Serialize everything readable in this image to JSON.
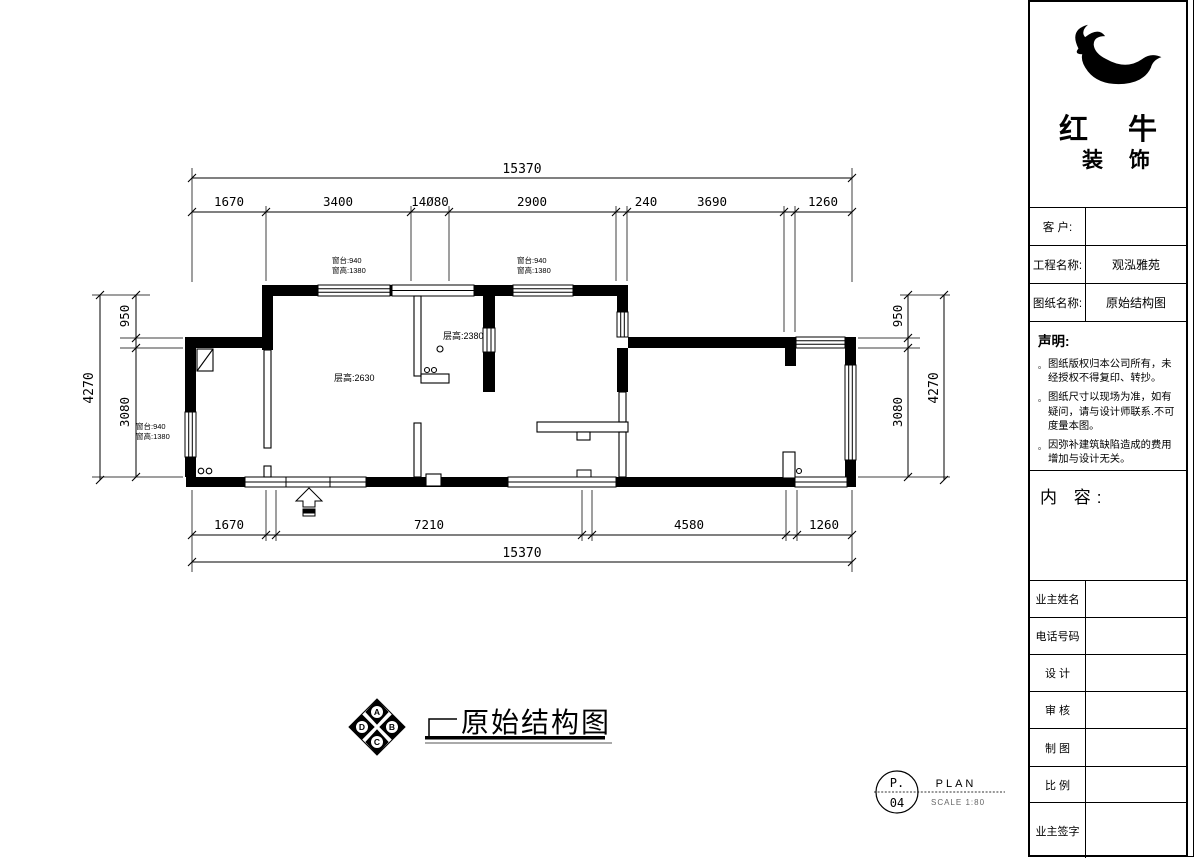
{
  "plan": {
    "dims_top": {
      "total": "15370",
      "segments": [
        "1670",
        "3400",
        "14Ø80",
        "2900",
        "240",
        "3690",
        "1260"
      ]
    },
    "dims_bottom": {
      "total": "15370",
      "segments": [
        "1670",
        "7210",
        "4580",
        "1260"
      ]
    },
    "dims_left": {
      "overall": "4270",
      "upper": "950",
      "lower": "3080"
    },
    "dims_right": {
      "overall": "4270",
      "upper": "950",
      "lower": "3080"
    },
    "window_note": {
      "sill": "窗台:940",
      "height": "窗高:1380"
    },
    "room_notes": {
      "room_main": "层高:2630",
      "room_mid": "层高:2380"
    }
  },
  "drawing_title": {
    "text": "原始结构图",
    "compass": {
      "top": "A",
      "right": "B",
      "bottom": "C",
      "left": "D"
    }
  },
  "page_marker": {
    "page_prefix": "P.",
    "page_number": "04",
    "type": "PLAN",
    "scale": "SCALE 1:80"
  },
  "title_block": {
    "brand_top": "红 牛",
    "brand_bottom": "装 饰",
    "rows": [
      {
        "label": "客  户:",
        "value": ""
      },
      {
        "label": "工程名称:",
        "value": "观泓雅苑"
      },
      {
        "label": "图纸名称:",
        "value": "原始结构图"
      }
    ],
    "statement": {
      "heading": "声明:",
      "bullet": "。",
      "items": [
        "图纸版权归本公司所有，未经授权不得复印、转抄。",
        "图纸尺寸以现场为准，如有疑问，请与设计师联系.不可度量本图。",
        "因弥补建筑缺陷造成的费用增加与设计无关。"
      ]
    },
    "content_label": "内 容:",
    "info_rows": [
      {
        "label": "业主姓名",
        "value": ""
      },
      {
        "label": "电话号码",
        "value": ""
      },
      {
        "label": "设  计",
        "value": ""
      },
      {
        "label": "审  核",
        "value": ""
      },
      {
        "label": "制  图",
        "value": ""
      },
      {
        "label": "比  例",
        "value": ""
      },
      {
        "label": "业主签字",
        "value": ""
      }
    ]
  }
}
